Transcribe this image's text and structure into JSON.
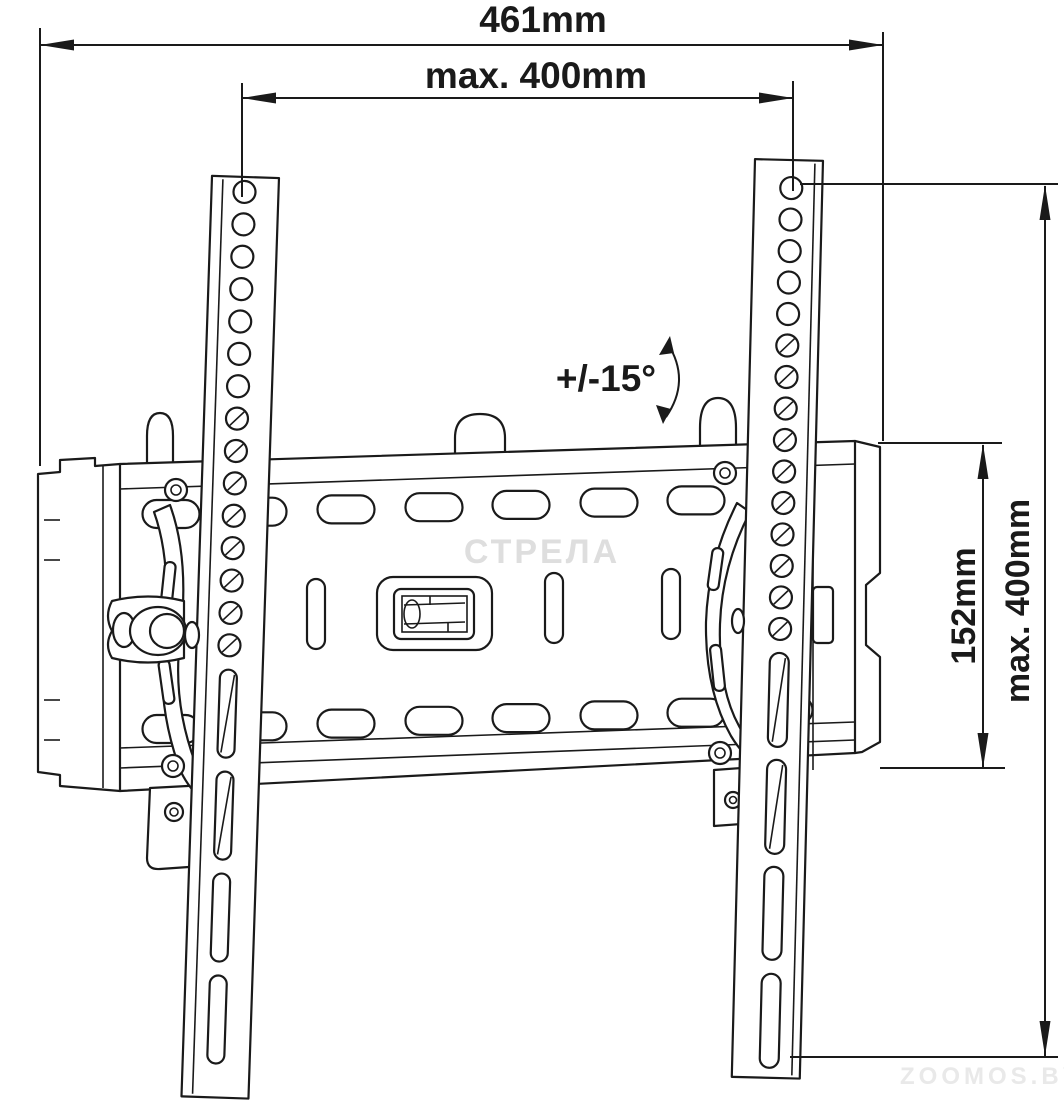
{
  "diagram": {
    "type": "technical-drawing",
    "subject": "tilting TV wall mount bracket, front view with dimensions",
    "labels": {
      "top_width": "461mm",
      "hole_span": "max. 400mm",
      "tilt": "+/-15°",
      "plate_height": "152mm",
      "side_span": "max. 400mm"
    },
    "watermarks": {
      "center": "СТРЕЛА",
      "bottom": "ZOOMOS.BY"
    },
    "colors": {
      "line": "#1a1a1a",
      "background": "#ffffff",
      "watermark": "#dedede"
    }
  }
}
